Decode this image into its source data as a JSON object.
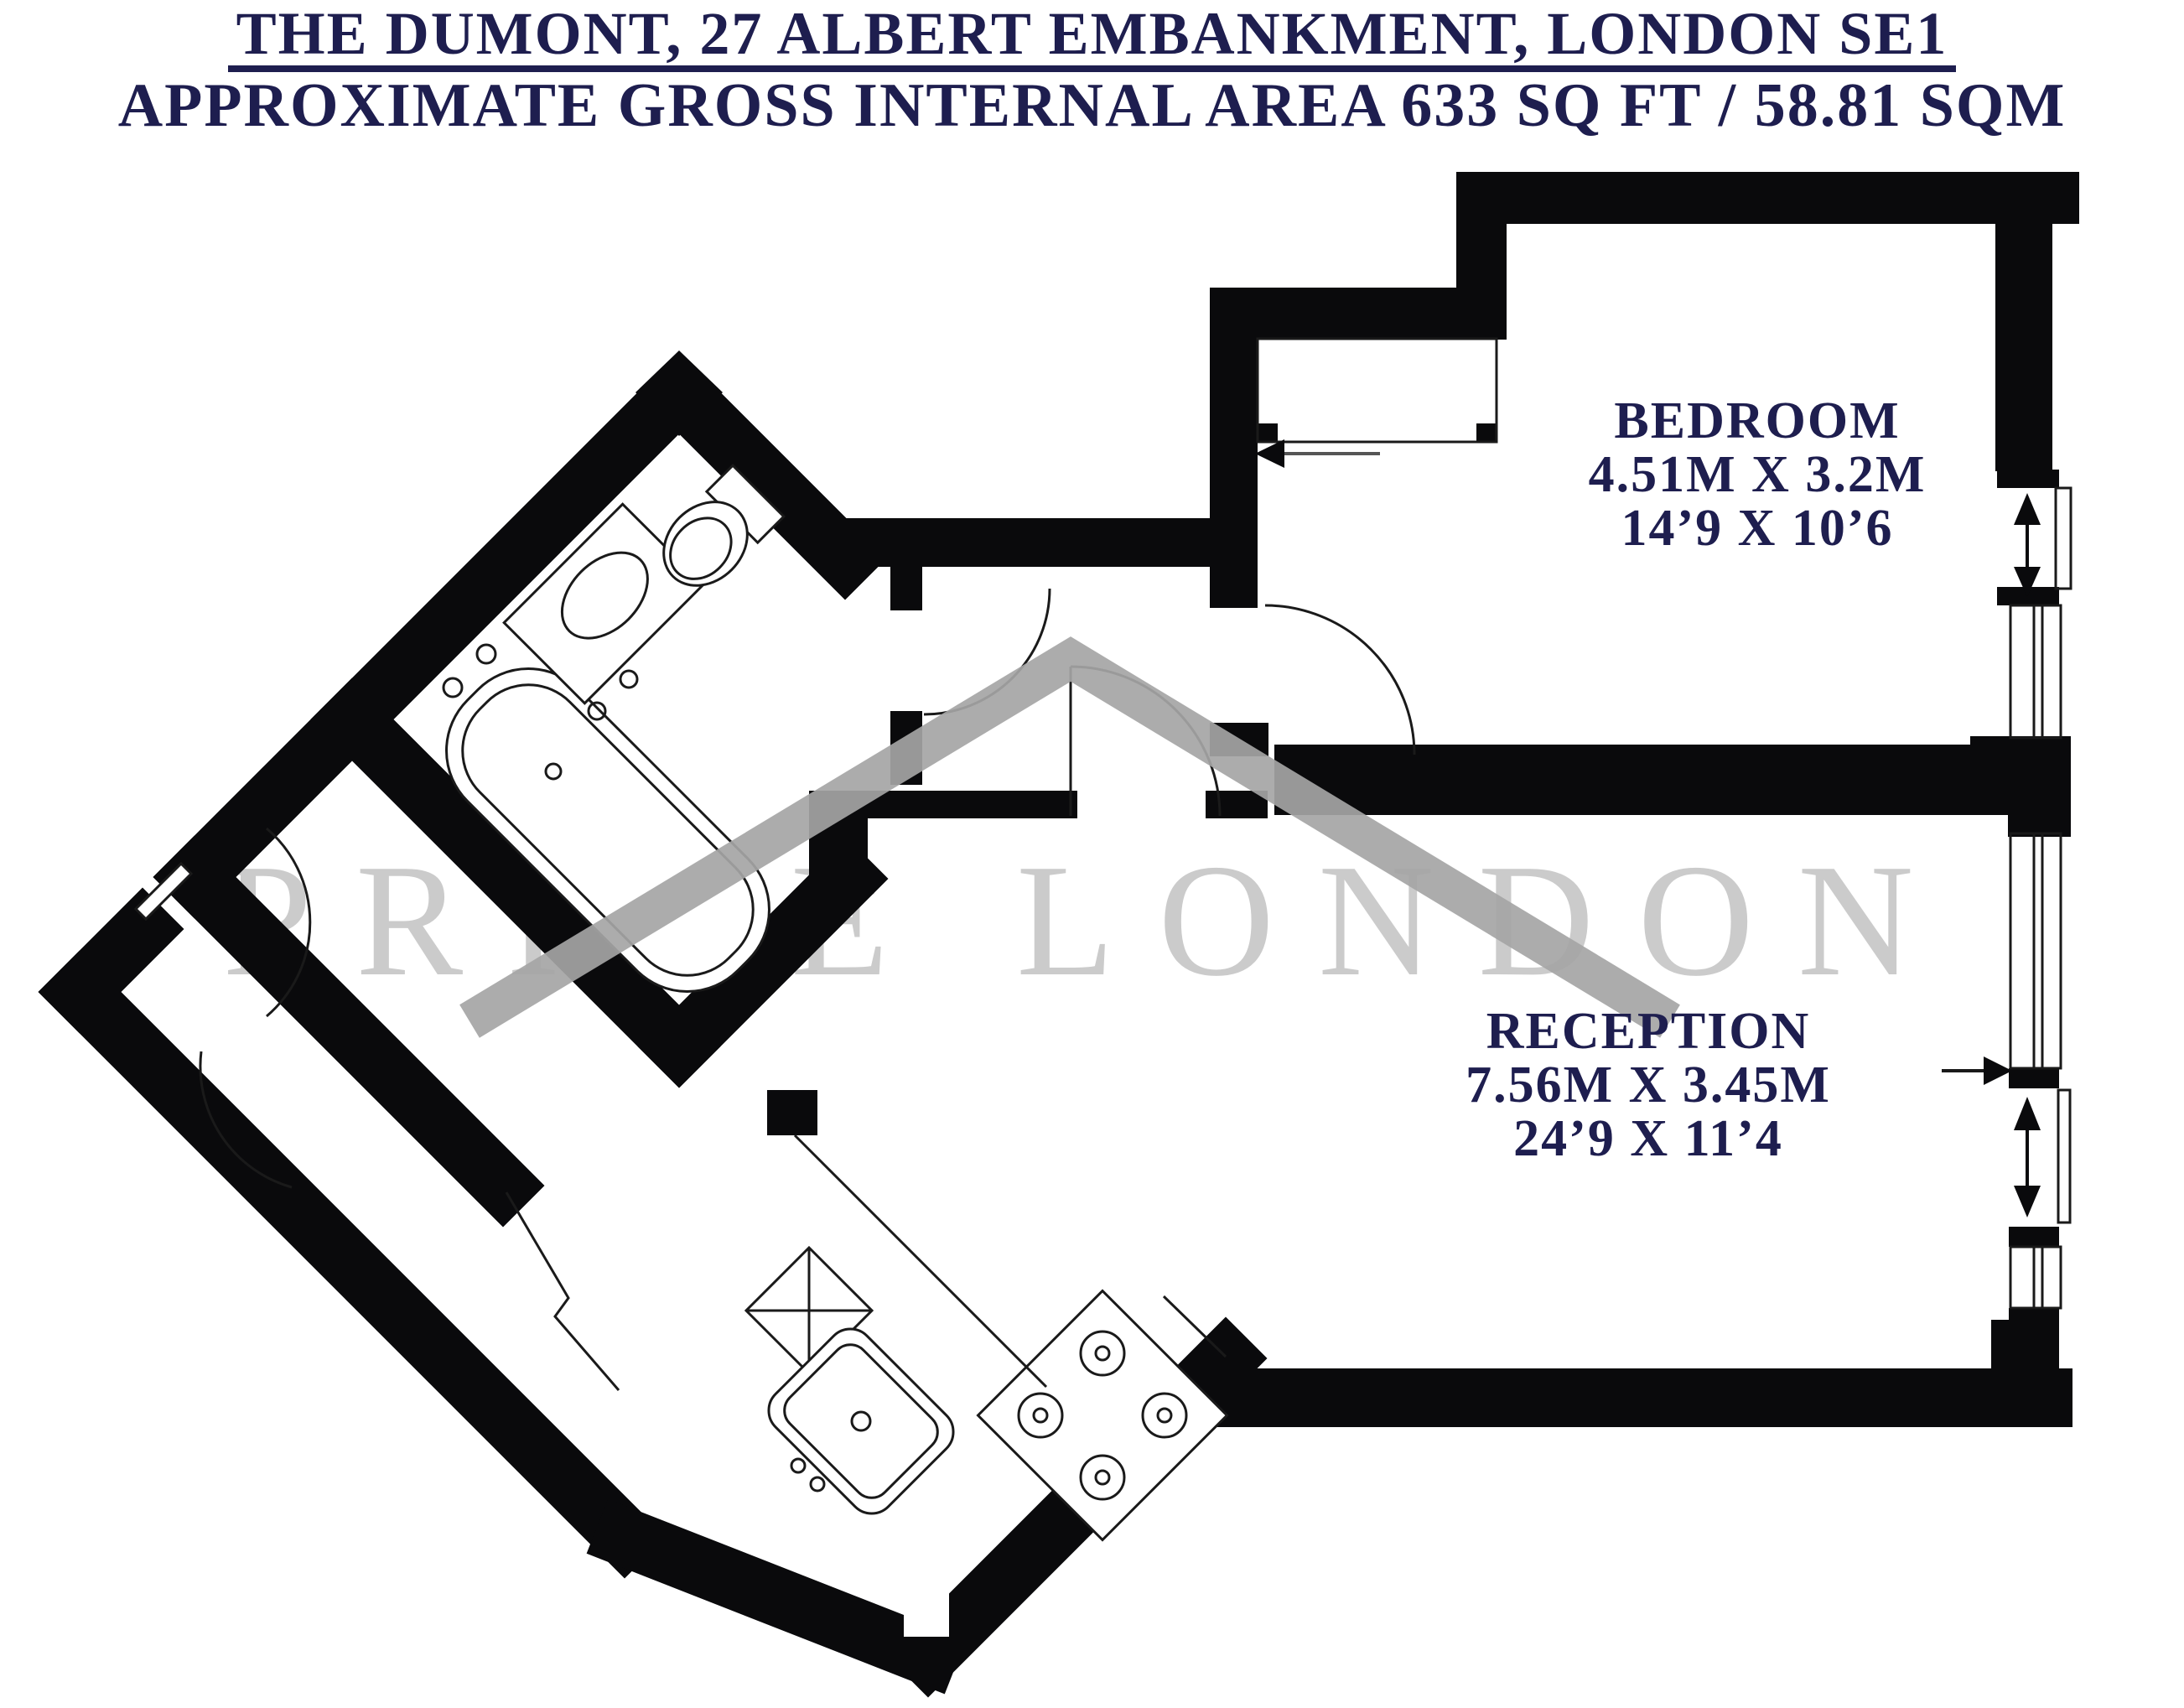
{
  "title": {
    "line1": "THE DUMONT, 27 ALBERT EMBANKMENT, LONDON SE1",
    "line2": "APPROXIMATE GROSS INTERNAL AREA 633 SQ FT / 58.81 SQM"
  },
  "watermark": {
    "text": "PRIME LONDON"
  },
  "rooms": {
    "bedroom": {
      "name": "BEDROOM",
      "metric": "4.51M X 3.2M",
      "imperial": "14’9 X 10’6"
    },
    "reception": {
      "name": "RECEPTION",
      "metric": "7.56M X 3.45M",
      "imperial": "24’9 X 11’4"
    }
  },
  "colors": {
    "text_navy": "#1e1e4f",
    "wall_black": "#0a0a0c",
    "watermark_gray": "#cbcbcb",
    "roof_gray": "#a5a5a5"
  }
}
